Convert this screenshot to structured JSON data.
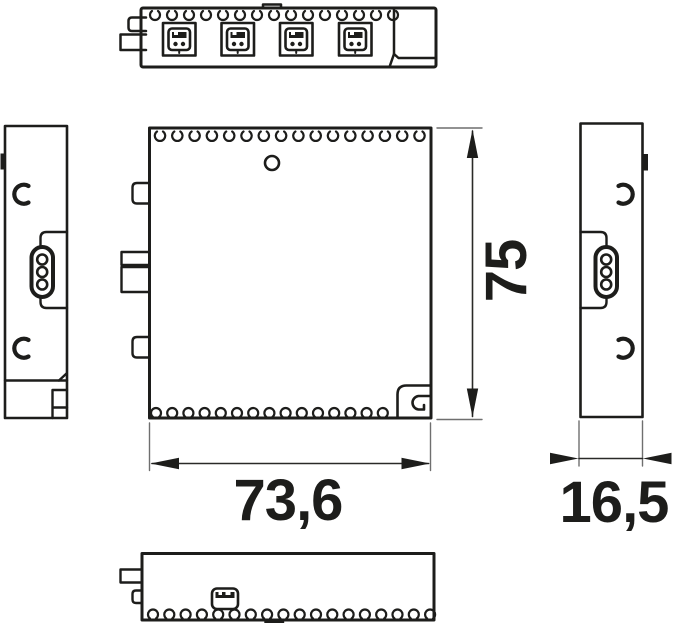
{
  "colors": {
    "ink": "#1d1d1b",
    "background": "#ffffff",
    "helper_line": "#6f6f6f"
  },
  "dimensions": {
    "height": {
      "value": "75",
      "orientation": "vertical"
    },
    "width": {
      "value": "73,6",
      "orientation": "horizontal"
    },
    "depth": {
      "value": "16,5",
      "orientation": "horizontal"
    }
  },
  "views": {
    "top": "top-view",
    "left": "left-side-view",
    "front": "front-view",
    "right": "right-side-view",
    "bottom": "bottom-view"
  },
  "icons": {
    "connector_port": "socket-port-icon",
    "round_connector": "three-pin-oval-connector-icon",
    "usb_port": "mini-usb-port-icon",
    "vent": "vent-perforation-icon",
    "crescent": "crescent-cutout-icon",
    "mounting_slot": "mounting-slot-icon"
  }
}
